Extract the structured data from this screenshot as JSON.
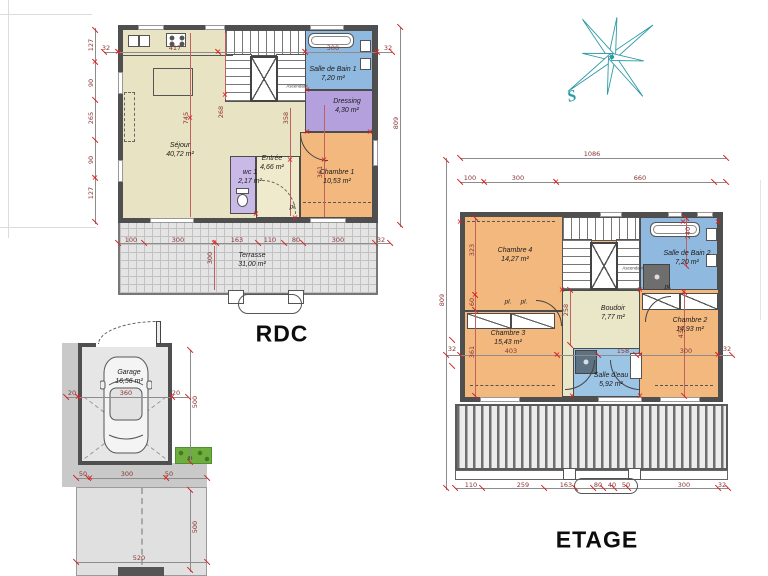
{
  "titles": {
    "rdc": "RDC",
    "etage": "ETAGE"
  },
  "compass": {
    "letter": "S"
  },
  "colors": {
    "wall": "#4f4f4f",
    "living": "#e8e3c2",
    "bedroom": "#f2b87e",
    "bathroom": "#8fb9de",
    "dressing": "#b3a0dc",
    "wc": "#c8b9e6",
    "terrace": "#e4e4e4",
    "hedge": "#6fae3e",
    "compass": "#2e9aa6",
    "dimension_text": "#8a3434",
    "marker": "#e01f1f"
  },
  "rdc": {
    "rooms": {
      "sejour": {
        "name": "Séjour",
        "area": "40,72 m²"
      },
      "wc": {
        "name": "wc 1",
        "area": "2,17 m²"
      },
      "entree": {
        "name": "Entrée",
        "area": "4,66 m²"
      },
      "ch1": {
        "name": "Chambre 1",
        "area": "10,53 m²"
      },
      "sdb1": {
        "name": "Salle de Bain 1",
        "area": "7,20 m²"
      },
      "dressing": {
        "name": "Dressing",
        "area": "4,30 m²"
      },
      "terrasse": {
        "name": "Terrasse",
        "area": "31,00 m²"
      }
    },
    "labels": {
      "pl": "pl.",
      "asc": "Ascendant"
    },
    "dims": {
      "l32": "32",
      "t417": "417",
      "t300": "300",
      "r32": "32",
      "s127a": "127",
      "s90a": "90",
      "s265": "265",
      "s90b": "90",
      "s127b": "127",
      "v745": "745",
      "v268": "268",
      "v358": "358",
      "v361": "361",
      "r809": "809",
      "terr300": "300",
      "b100": "100",
      "b300a": "300",
      "b163": "163",
      "b110": "110",
      "b80": "80",
      "b300b": "300",
      "b32": "32"
    }
  },
  "garage": {
    "room": {
      "name": "Garage",
      "area": "16,56 m²"
    },
    "dims": {
      "s20a": "20",
      "w360": "360",
      "s20b": "20",
      "v500a": "500",
      "b50a": "50",
      "b300": "300",
      "b50b": "50",
      "v500b": "500",
      "b520": "520"
    }
  },
  "etage": {
    "rooms": {
      "ch4": {
        "name": "Chambre 4",
        "area": "14,27 m²"
      },
      "ch3": {
        "name": "Chambre 3",
        "area": "15,43 m²"
      },
      "ch2": {
        "name": "Chambre 2",
        "area": "14,93 m²"
      },
      "boudoir": {
        "name": "Boudoir",
        "area": "7,77 m²"
      },
      "sdb2": {
        "name": "Salle de Bain 2",
        "area": "7,20 m²"
      },
      "sde": {
        "name": "Salle d'eau",
        "area": "5,92 m²"
      }
    },
    "labels": {
      "pl1": "pl.",
      "pl2": "pl.",
      "pl3": "pl.",
      "asc": "Ascendant"
    },
    "dims": {
      "t1086": "1086",
      "t100": "100",
      "t300": "300",
      "t660": "660",
      "l809": "809",
      "l32": "32",
      "s323": "323",
      "s60": "60",
      "s361": "361",
      "m403": "403",
      "m158": "158",
      "m300": "300",
      "r32": "32",
      "v258": "258",
      "v240": "240",
      "v433": "433",
      "b110": "110",
      "b259": "259",
      "b163": "163",
      "b80": "80",
      "b40": "40",
      "b50": "50",
      "b300": "300",
      "b32": "32"
    }
  }
}
